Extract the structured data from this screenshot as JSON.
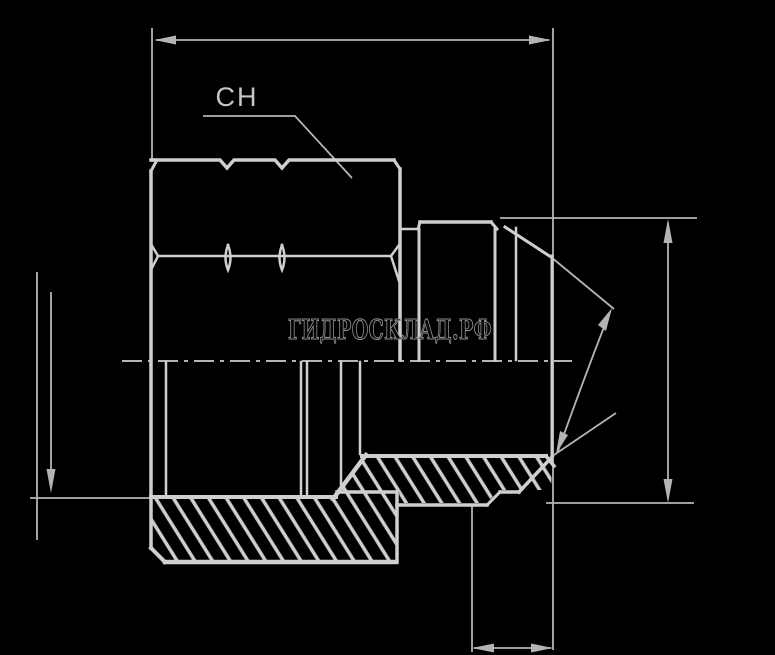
{
  "watermark": {
    "text": "ГИДРОСКЛАД.РФ"
  },
  "labels": {
    "wrench_size": "CH"
  },
  "colors": {
    "background": "#000000",
    "line_main": "#cdcfd1",
    "line_thin": "#b2b4b6",
    "watermark_outline": "#8c8e90",
    "watermark_fill": "#060606"
  },
  "drawing": {
    "type": "technical-cross-section",
    "subject": "hydraulic hose fitting: swivel nut with 74-degree JIC cone male end",
    "annotations": [
      "overall-length-dimension-top",
      "nut-height-dimension-left",
      "cone-diameter-dimension-right",
      "nose-length-dimension-bottom",
      "cone-angle-arc-annotation",
      "wrench-size-leader"
    ]
  }
}
